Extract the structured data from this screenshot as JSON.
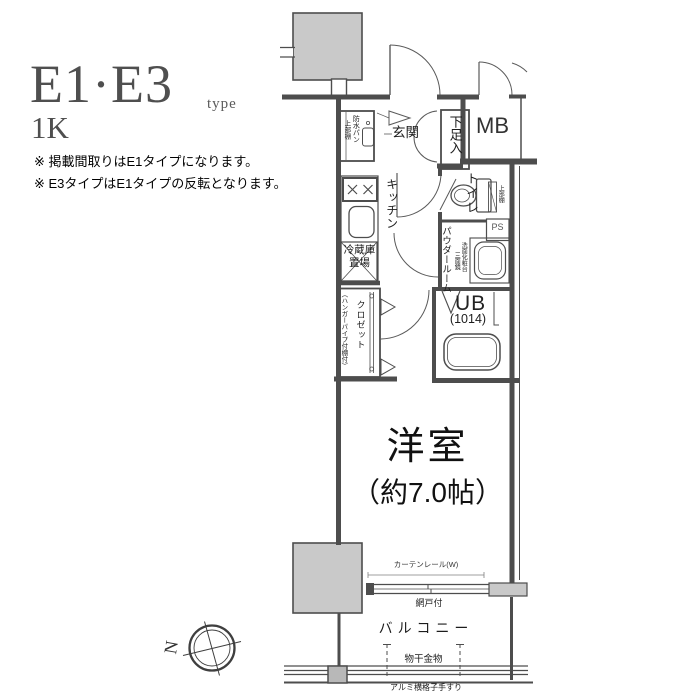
{
  "palette": {
    "line": "#4d4d4d",
    "column_fill": "#c9c9c9",
    "background": "#ffffff"
  },
  "header": {
    "title": "E1·E3",
    "type_label": "type",
    "plan_type": "1K",
    "notes": [
      "※ 掲載間取りはE1タイプになります。",
      "※ E3タイプはE1タイプの反転となります。"
    ]
  },
  "plan": {
    "entrance_label": "玄関",
    "shoe_box_label": "下足入",
    "meter_box_label": "MB",
    "laundry": {
      "pan_label": "防水パン",
      "shelf_label": "上部棚"
    },
    "kitchen_label": "キッチン",
    "fridge_line1": "冷蔵庫",
    "fridge_line2": "置場",
    "toilet_label": "トイレ",
    "toilet_shelf_label": "上部棚",
    "powder_room_label": "パウダールーム",
    "vanity_label": "洗面化粧台",
    "vanity_mirror_label": "三面鏡",
    "pipe_space_label": "PS",
    "unit_bath_label": "UB",
    "unit_bath_size": "(1014)",
    "closet_label": "クロゼット",
    "closet_note": "（ハンガーパイプ付棚付）",
    "main_room_label": "洋室",
    "main_room_size": "（約7.0帖）",
    "curtain_rail_label": "カーテンレール(W)",
    "screen_door_label": "網戸付",
    "balcony_label": "バルコニー",
    "drying_fixture_label": "物干金物",
    "handrail_label": "アルミ横格子手すり",
    "compass_north": "N"
  }
}
